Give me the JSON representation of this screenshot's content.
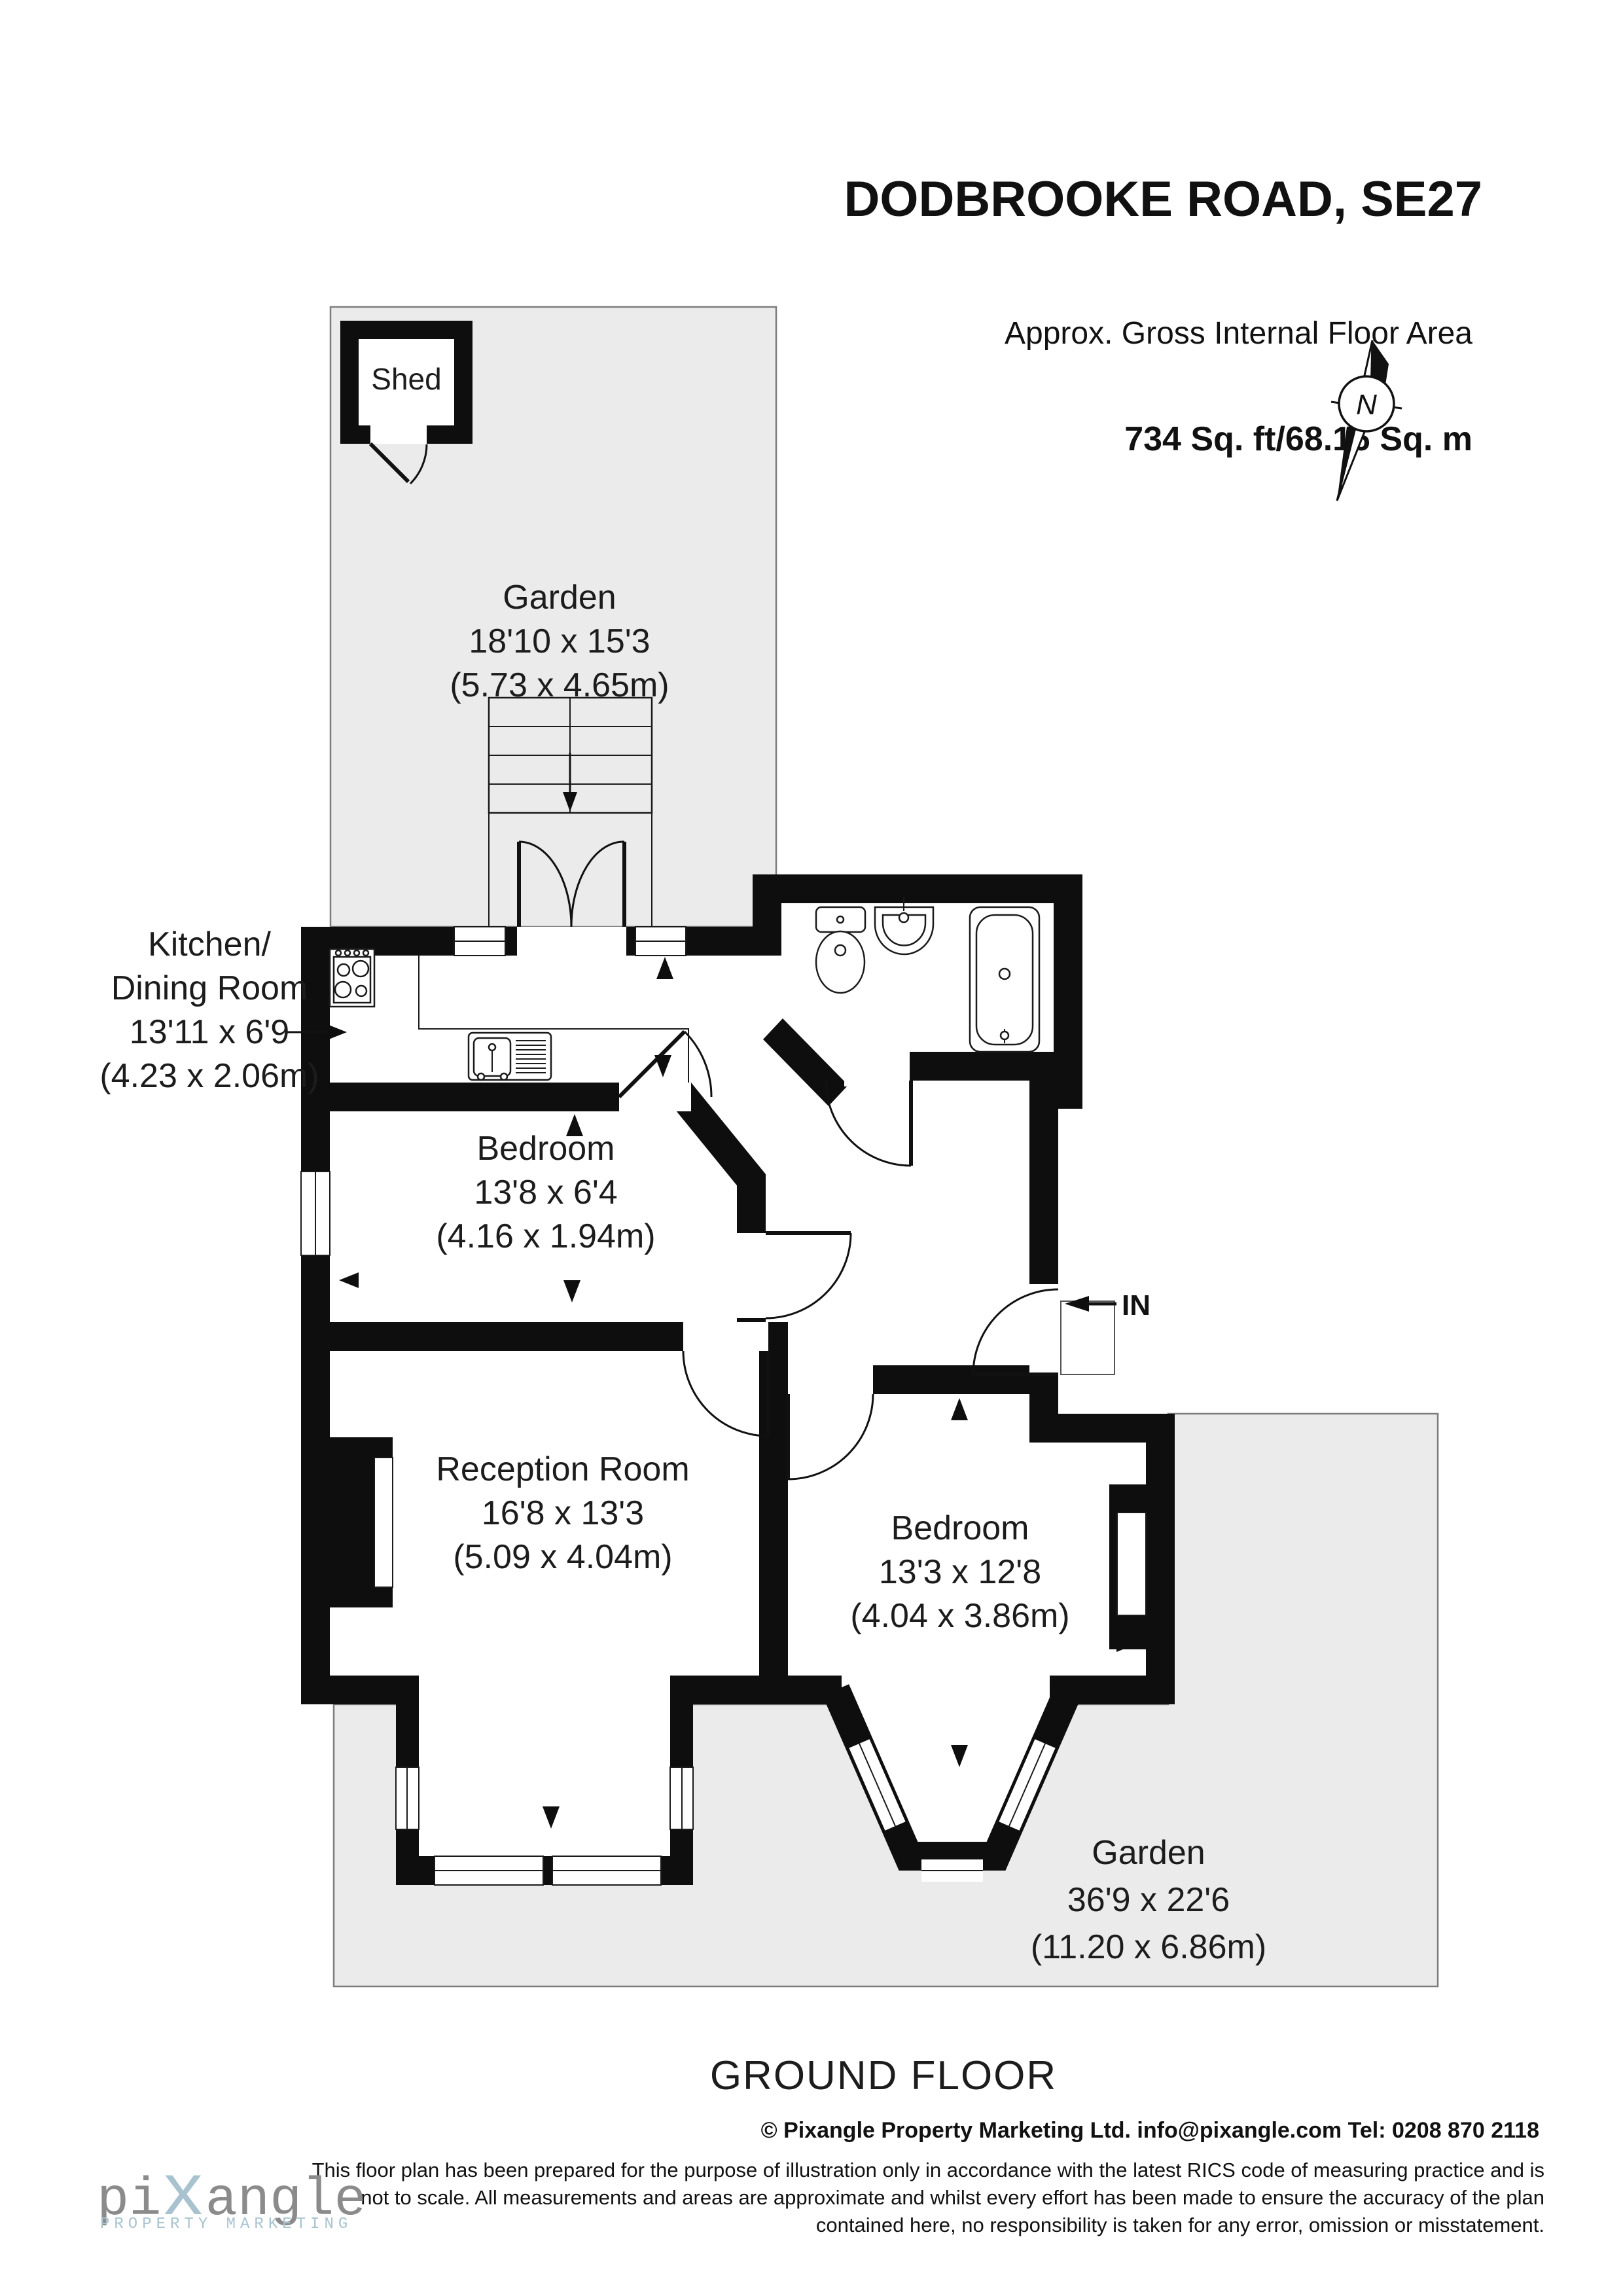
{
  "header": {
    "title": "DODBROOKE ROAD, SE27",
    "subtitle": "Approx. Gross Internal Floor Area",
    "area": "734 Sq. ft/68.16 Sq. m"
  },
  "compass": {
    "north_label": "N"
  },
  "rooms": {
    "shed": {
      "name": "Shed"
    },
    "garden_top": {
      "name": "Garden",
      "imperial": "18'10 x 15'3",
      "metric": "(5.73 x 4.65m)"
    },
    "kitchen": {
      "name_line1": "Kitchen/",
      "name_line2": "Dining Room",
      "imperial": "13'11 x 6'9",
      "metric": "(4.23 x 2.06m)"
    },
    "bedroom1": {
      "name": "Bedroom",
      "imperial": "13'8 x 6'4",
      "metric": "(4.16 x 1.94m)"
    },
    "reception": {
      "name": "Reception Room",
      "imperial": "16'8 x 13'3",
      "metric": "(5.09 x 4.04m)"
    },
    "bedroom2": {
      "name": "Bedroom",
      "imperial": "13'3 x 12'8",
      "metric": "(4.04 x 3.86m)"
    },
    "garden_bottom": {
      "name": "Garden",
      "imperial": "36'9 x 22'6",
      "metric": "(11.20 x 6.86m)"
    }
  },
  "entrance": {
    "label": "IN"
  },
  "floor_label": "GROUND FLOOR",
  "footer": {
    "contact": "© Pixangle Property Marketing Ltd. info@pixangle.com Tel: 0208 870 2118",
    "disclaimer_line1": "This floor plan has been prepared for the purpose of illustration only in accordance with the latest RICS code of measuring practice and is",
    "disclaimer_line2": "not to scale. All measurements and areas are approximate and whilst every effort has been made to ensure the accuracy of the plan",
    "disclaimer_line3": "contained here, no responsibility is taken for any error, omission or misstatement."
  },
  "logo": {
    "part1": "pi",
    "part2": "x",
    "part3": "angle",
    "tagline": "PROPERTY MARKETING"
  },
  "colors": {
    "garden": "#ebebec",
    "wall": "#0e0e0e",
    "logo_gray": "#8b8b8b",
    "logo_blue": "#a8c3cf"
  }
}
